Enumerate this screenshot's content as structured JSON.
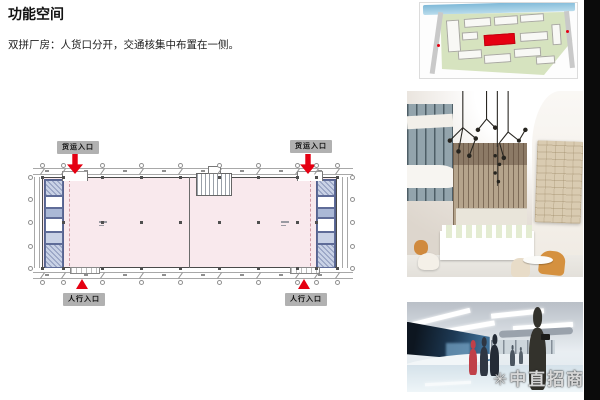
{
  "page": {
    "background": "#ffffff",
    "right_band_color": "#0b0b0b"
  },
  "header": {
    "title": "功能空间",
    "subtitle": "双拼厂房：人货口分开，交通核集中布置在一侧。"
  },
  "floor_plan": {
    "entrance_labels": {
      "freight_left": "货运入口",
      "freight_right": "货运入口",
      "pedestrian_left": "人行入口",
      "pedestrian_right": "人行入口"
    },
    "colors": {
      "hall_fill": "#f9e9ed",
      "core_fill": "#abb8d6",
      "entrance_red": "#e50012",
      "label_background": "#b1b1b1",
      "wall_line": "#4a4a4a",
      "dimension_line": "#a8a8a8"
    }
  },
  "side_images": {
    "site_plan": {
      "highlight_building_color": "#e60012",
      "water_color": "#7fb9d8",
      "greenery_color": "#d6e3bf"
    },
    "lobby_photo": {
      "wood_tone": "#b5a48c",
      "accent_chair_color": "#d5913f"
    },
    "exhibition_photo": {
      "watermark_mark": "✳",
      "watermark_text": "中直招商网",
      "screen_color": "#274a66"
    }
  }
}
